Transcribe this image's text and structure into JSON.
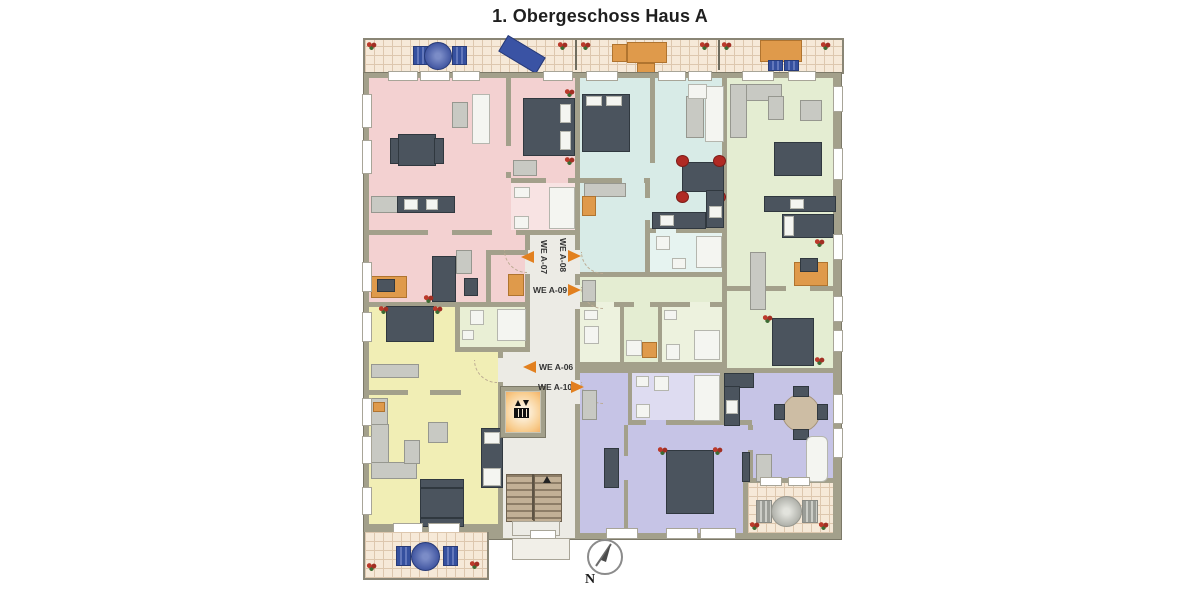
{
  "title": "1. Obergeschoss Haus A",
  "compass": {
    "label": "N"
  },
  "apartments": [
    {
      "id": "we-a-06",
      "label": "WE A-06",
      "color": "#f1eeb5",
      "bath": "#e9efd5",
      "arrow": "left"
    },
    {
      "id": "we-a-07",
      "label": "WE A-07",
      "color": "#f3d1d1",
      "bath": "#f8e3e3",
      "arrow": "left"
    },
    {
      "id": "we-a-08",
      "label": "WE A-08",
      "color": "#d8ebe7",
      "bath": "#e6f3f0",
      "arrow": "right"
    },
    {
      "id": "we-a-09",
      "label": "WE A-09",
      "color": "#e4edd2",
      "bath": "#edf2de",
      "arrow": "right"
    },
    {
      "id": "we-a-10",
      "label": "WE A-10",
      "color": "#c6c4e6",
      "bath": "#dedcf1",
      "arrow": "right"
    }
  ],
  "colors": {
    "wall": "#a3a08b",
    "wall_edge": "#7c7968",
    "corridor": "#ecebe5",
    "balcony_floor": "#f6e9d8",
    "balcony_line": "#ddc7ae",
    "furn_dark": "#4b545e",
    "furn_gray": "#c8c9c3",
    "furn_white": "#f4f5f1",
    "furn_orange": "#df9a4b",
    "furn_blue": "#3a53a4",
    "furn_red": "#b02a24",
    "accent_arrow": "#e2801f",
    "text": "#333333"
  }
}
